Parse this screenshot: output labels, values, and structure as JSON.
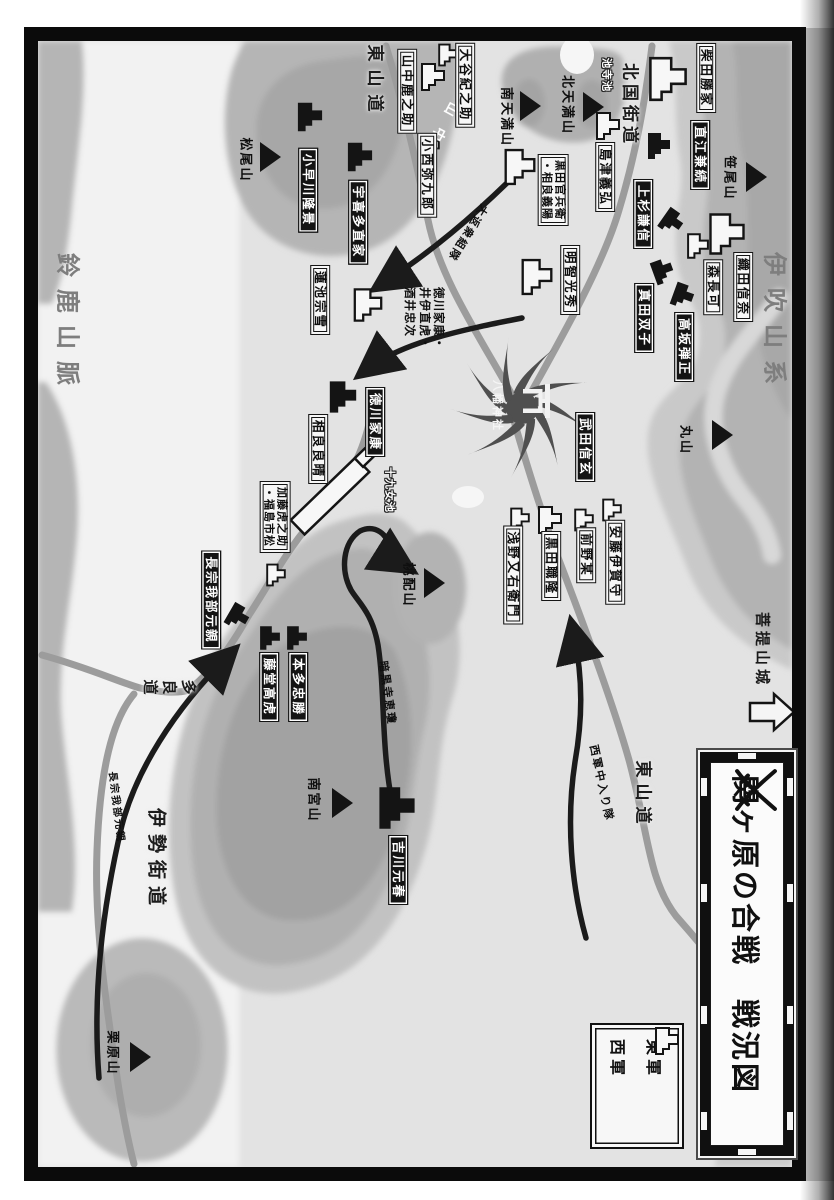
{
  "title": {
    "text": "関ヶ原の合戦　戦況図",
    "icon": "crossed-swords-icon"
  },
  "legend": {
    "east": {
      "label": "東軍",
      "icon": "castle-icon-black"
    },
    "west": {
      "label": "西軍",
      "icon": "castle-icon-white"
    }
  },
  "colors": {
    "east_army": "#141414",
    "west_army": "#f7f7f7",
    "paper": "#e3e3e3",
    "terrain_gray": "#b3b3b3",
    "road_gray": "#9c9c9c",
    "starburst_gray": "#4f4f4f"
  },
  "units": {
    "west": [
      {
        "name": "山中鹿之助"
      },
      {
        "name": "大谷紀之助"
      },
      {
        "name": "小西弥九郎"
      },
      {
        "name": "蓮池宗雪"
      },
      {
        "name": "黒田官兵衛・相良義陽",
        "lines": [
          "黒田官兵衛",
          "・相良義陽"
        ]
      },
      {
        "name": "島津義弘"
      },
      {
        "name": "明智光秀"
      },
      {
        "name": "柴田勝家"
      },
      {
        "name": "織田信奈"
      },
      {
        "name": "森長可"
      },
      {
        "name": "相良良晴"
      },
      {
        "name": "加藤虎之助・福島市松",
        "lines": [
          "加藤虎之助",
          "・福島市松"
        ]
      },
      {
        "name": "浅野又右衛門"
      },
      {
        "name": "黒田職隆"
      },
      {
        "name": "前野某"
      },
      {
        "name": "安藤伊賀守"
      }
    ],
    "east": [
      {
        "name": "直江兼続"
      },
      {
        "name": "上杉謙信"
      },
      {
        "name": "真田双子"
      },
      {
        "name": "高坂弾正"
      },
      {
        "name": "武田信玄"
      },
      {
        "name": "徳川家康"
      },
      {
        "name": "小早川隆景"
      },
      {
        "name": "宇喜多直家"
      },
      {
        "name": "長宗我部元親"
      },
      {
        "name": "本多忠勝"
      },
      {
        "name": "藤堂高虎"
      },
      {
        "name": "吉川元春"
      }
    ]
  },
  "tokugawa_group": {
    "lines": [
      "徳川家康・",
      "井伊直虎・",
      "酒井忠次"
    ]
  },
  "mountains": [
    {
      "name": "松尾山"
    },
    {
      "name": "南天満山"
    },
    {
      "name": "北天満山"
    },
    {
      "name": "笹尾山"
    },
    {
      "name": "丸山"
    },
    {
      "name": "桃配山"
    },
    {
      "name": "南宮山"
    },
    {
      "name": "栗原山"
    }
  ],
  "roads": [
    {
      "name": "東山道"
    },
    {
      "name": "北国街道"
    },
    {
      "name": "東山道"
    },
    {
      "name": "伊勢街道"
    },
    {
      "name": "多良道"
    }
  ],
  "ranges": [
    {
      "name": "鈴鹿山脈"
    },
    {
      "name": "伊吹山系"
    }
  ],
  "ponds": [
    {
      "name": "池寺池"
    },
    {
      "name": "十九女池"
    }
  ],
  "shrine": {
    "name": "八幡神社",
    "icon": "torii-icon"
  },
  "bodai": {
    "name": "菩提山城",
    "icon": "hollow-arrow-icon"
  },
  "village": {
    "name": "山中"
  },
  "movements": [
    {
      "name": "大返衆組隊"
    },
    {
      "name": "西軍中入り隊"
    },
    {
      "name": "暗黒寺恵瓊"
    },
    {
      "name": "長宗我部元親"
    }
  ]
}
